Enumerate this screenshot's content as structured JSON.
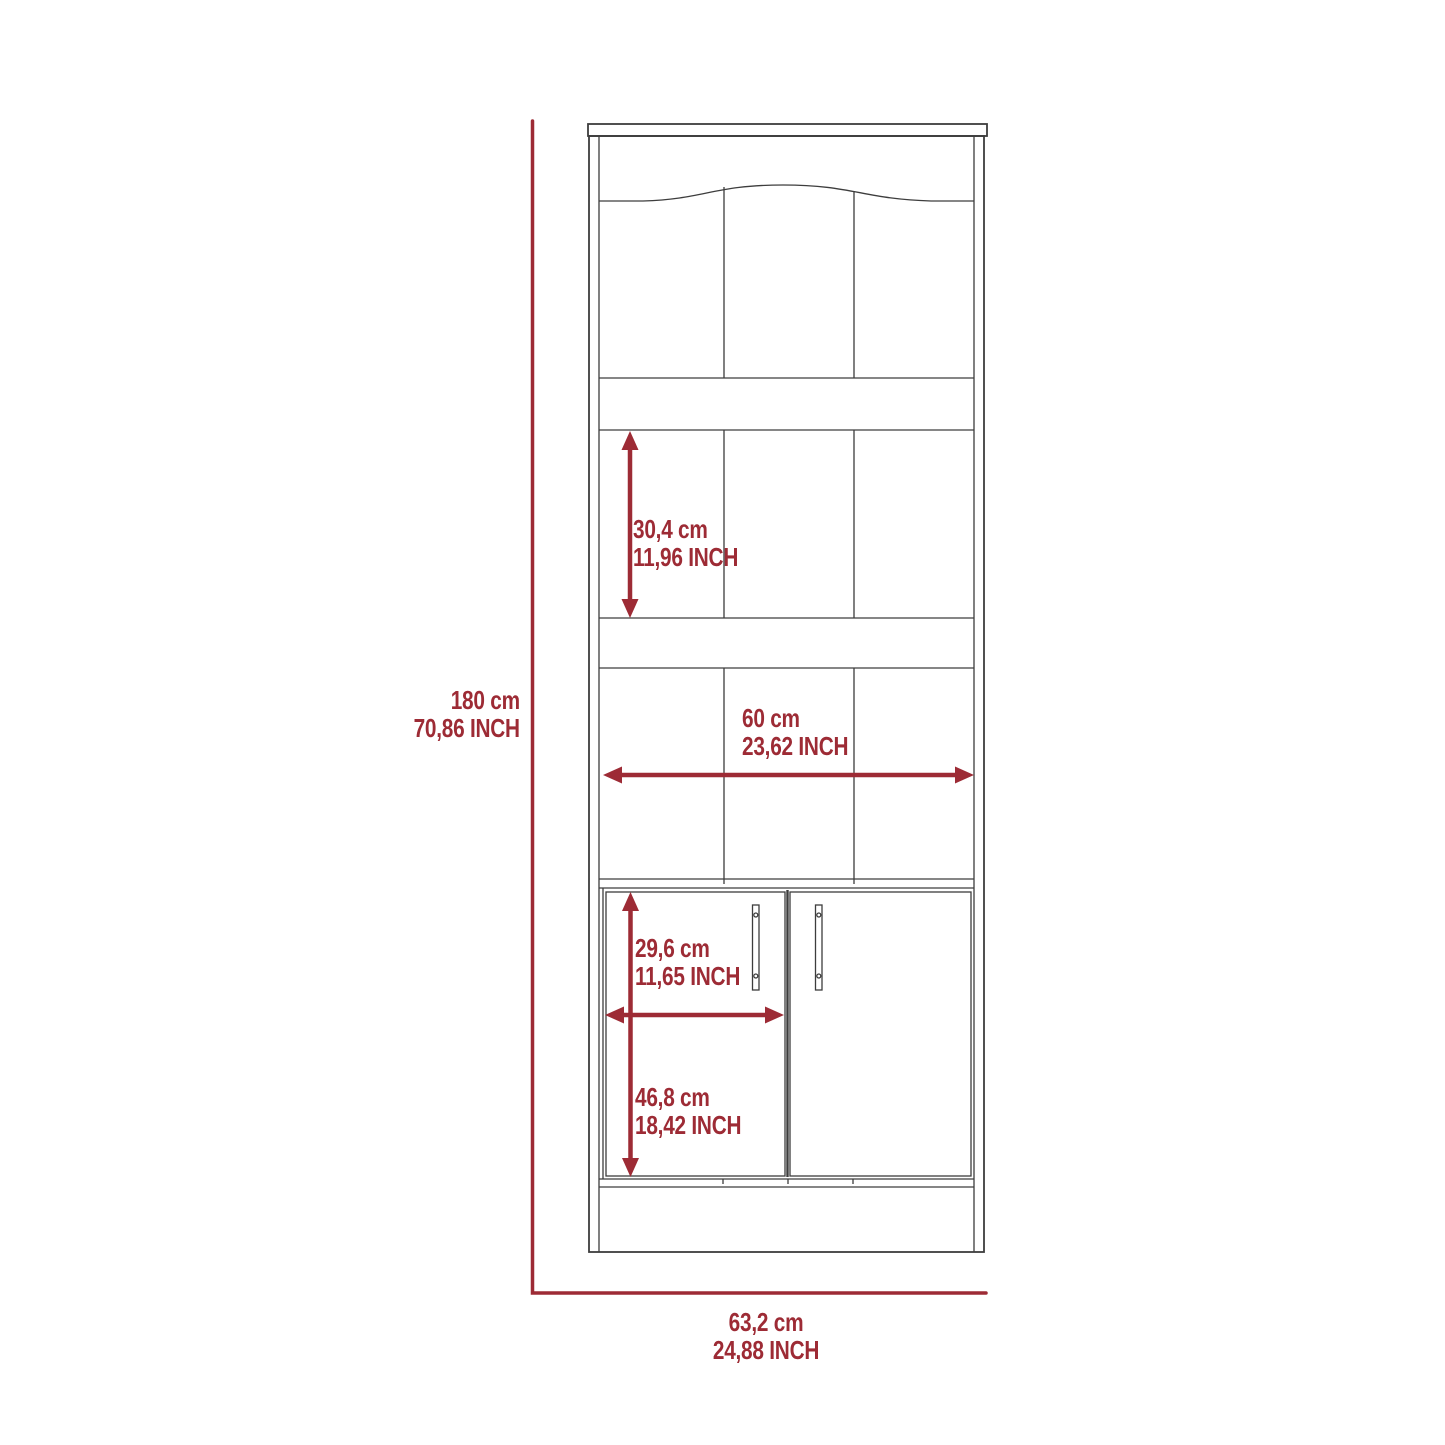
{
  "colors": {
    "accent": "#9d2b35",
    "line": "#3d3d3d",
    "background": "#ffffff"
  },
  "dimensions": {
    "overall_height": {
      "cm": "180 cm",
      "inch": "70,86 INCH"
    },
    "shelf_opening_height": {
      "cm": "30,4 cm",
      "inch": "11,96 INCH"
    },
    "inner_width": {
      "cm": "60 cm",
      "inch": "23,62 INCH"
    },
    "door_width": {
      "cm": "29,6 cm",
      "inch": "11,65 INCH"
    },
    "door_height": {
      "cm": "46,8 cm",
      "inch": "18,42 INCH"
    },
    "overall_width": {
      "cm": "63,2 cm",
      "inch": "24,88 INCH"
    }
  }
}
